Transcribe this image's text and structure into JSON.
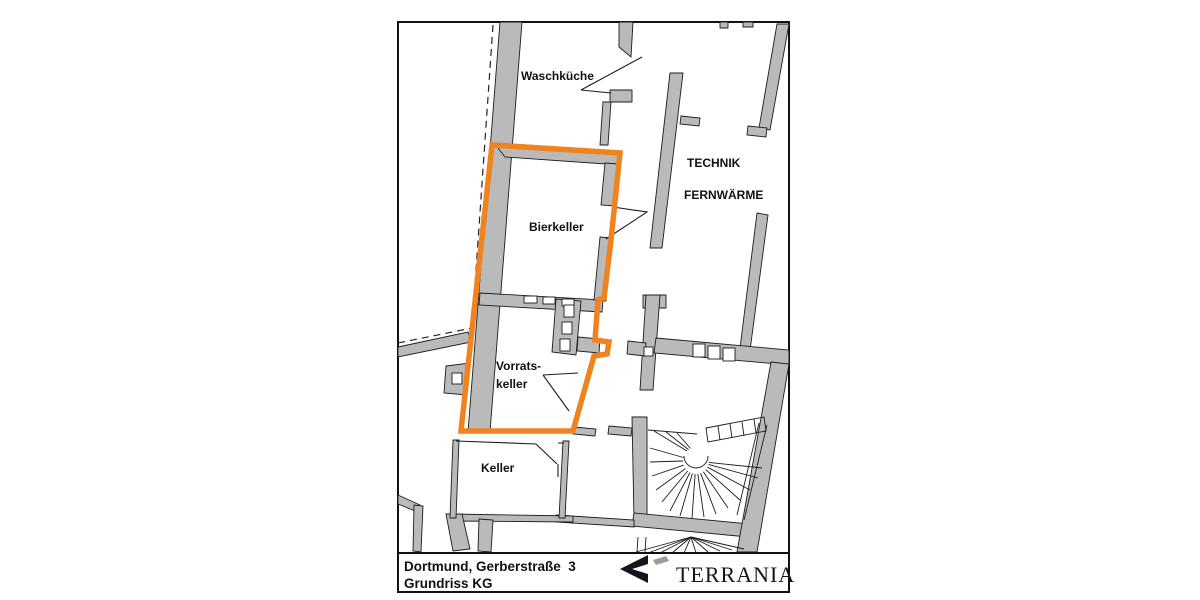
{
  "plan": {
    "labels": {
      "waschkueche": "Waschküche",
      "technik": "TECHNIK",
      "fernwaerme": "FERNWÄRME",
      "bierkeller": "Bierkeller",
      "vorratskeller_line1": "Vorrats-",
      "vorratskeller_line2": "keller",
      "keller": "Keller"
    },
    "highlight_color": "#EF8320",
    "wall_color": "#BABABA",
    "line_color": "#1C1C1C"
  },
  "title_block": {
    "address": "Dortmund, Gerberstraße  3",
    "drawing_title": "Grundriss KG",
    "brand_name": "TERRANIA"
  }
}
